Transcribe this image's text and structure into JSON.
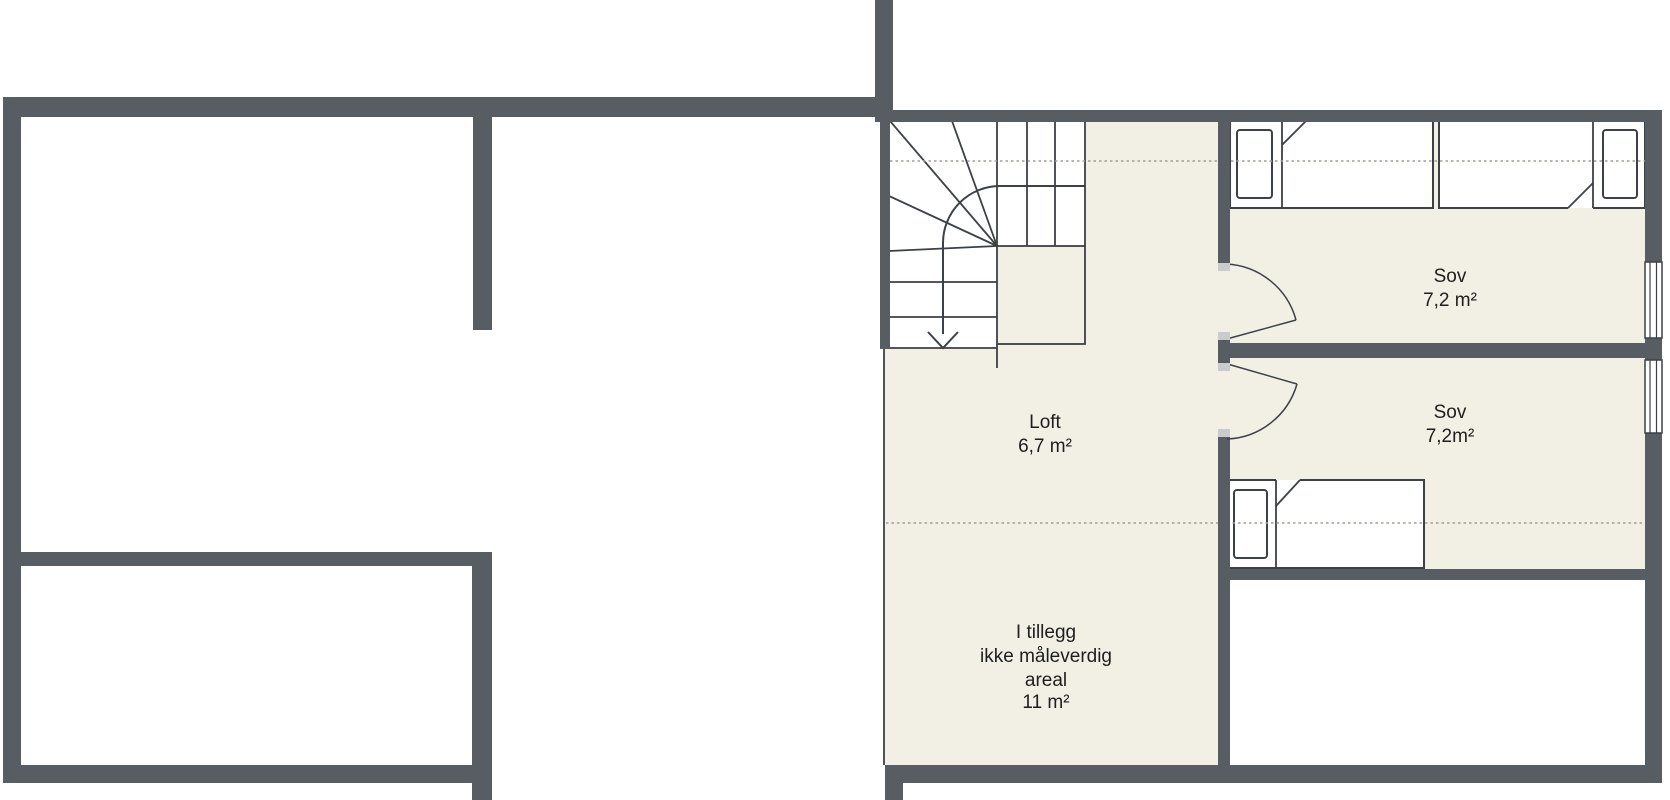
{
  "floorplan": {
    "type": "attic-floor-plan",
    "rooms": [
      {
        "name": "Loft",
        "area": "6,7 m²"
      },
      {
        "name": "Sov",
        "area": "7,2 m²"
      },
      {
        "name": "Sov",
        "area": "7,2m²"
      }
    ],
    "additional_area": {
      "line1": "I tillegg",
      "line2": "ikke måleverdig",
      "line3": "areal",
      "line4": "11 m²"
    },
    "features": {
      "staircase": "quarter-turn winder stair with down arrow",
      "beds": 3,
      "doors": 2,
      "windows": 2
    },
    "colors": {
      "wall": "#585d64",
      "floor": "#f2efe4",
      "line": "#3c4147",
      "dashed_line": "#a39e91",
      "door_jamb": "#c9cbcd",
      "text": "#1e1e1e",
      "background": "#ffffff"
    }
  }
}
